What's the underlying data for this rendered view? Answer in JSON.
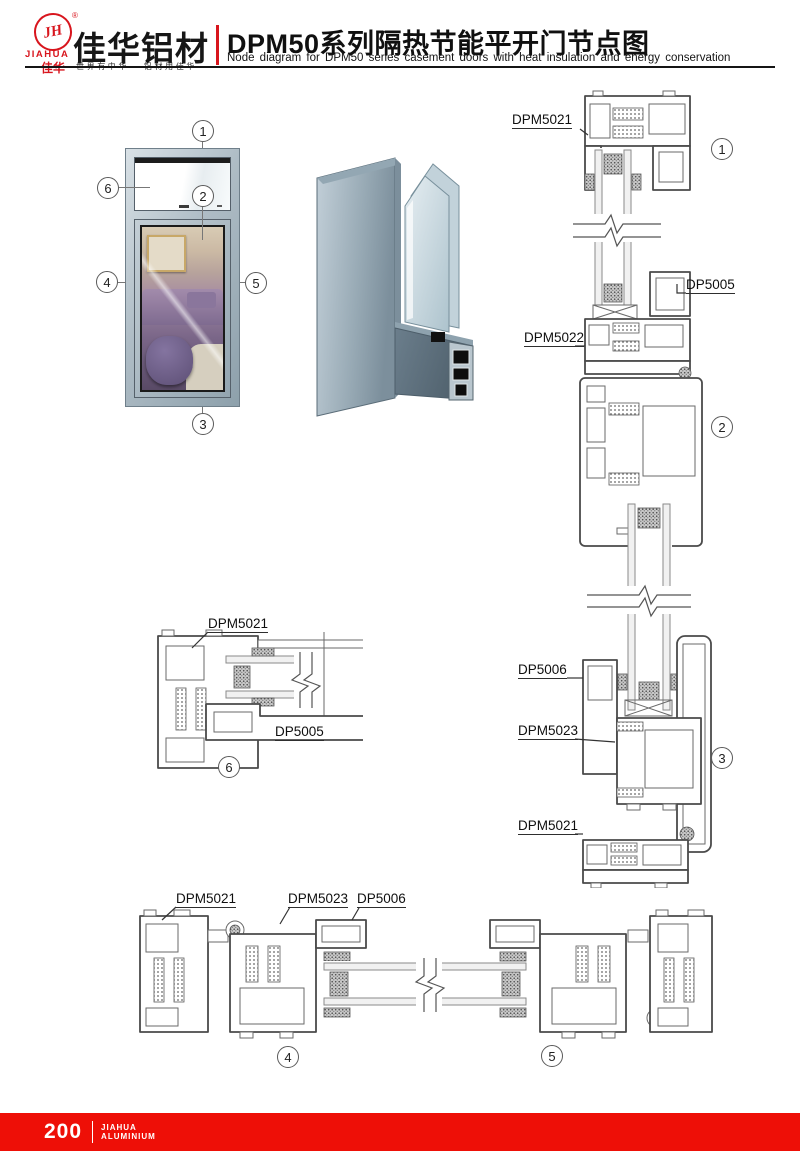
{
  "colors": {
    "brand_red": "#d8151d",
    "footer_red": "#ee0f07",
    "metal": "#9fb0bc",
    "drawing_line": "#4a4a4a"
  },
  "header": {
    "logo_mark": "JH",
    "registered": "®",
    "logo_en": "JIAHUA",
    "logo_cn": "佳华",
    "brand_cn": "佳华铝材",
    "slogan": "世界有中华 · 铝材用佳华",
    "title_cn": "DPM50系列隔热节能平开门节点图",
    "title_en": "Node diagram for DPM50 series casement doors with heat insulation and energy conservation"
  },
  "elevation": {
    "callouts": [
      "1",
      "2",
      "3",
      "4",
      "5",
      "6"
    ]
  },
  "sections": {
    "callouts": [
      "1",
      "2",
      "3",
      "4",
      "5",
      "6"
    ],
    "right_column": {
      "top_frame": "DPM5021",
      "transom_sill": "DP5005",
      "transom_bottom": "DPM5022",
      "door_bottom": "DP5006",
      "sash": "DPM5023",
      "bottom_frame": "DPM5021"
    },
    "detail6": {
      "frame": "DPM5021",
      "sill": "DP5005"
    },
    "bottom_row": {
      "left_frame": "DPM5021",
      "sash": "DPM5023",
      "door": "DP5006"
    }
  },
  "footer": {
    "page_number": "200",
    "brand_line1": "JIAHUA",
    "brand_line2": "ALUMINIUM"
  }
}
